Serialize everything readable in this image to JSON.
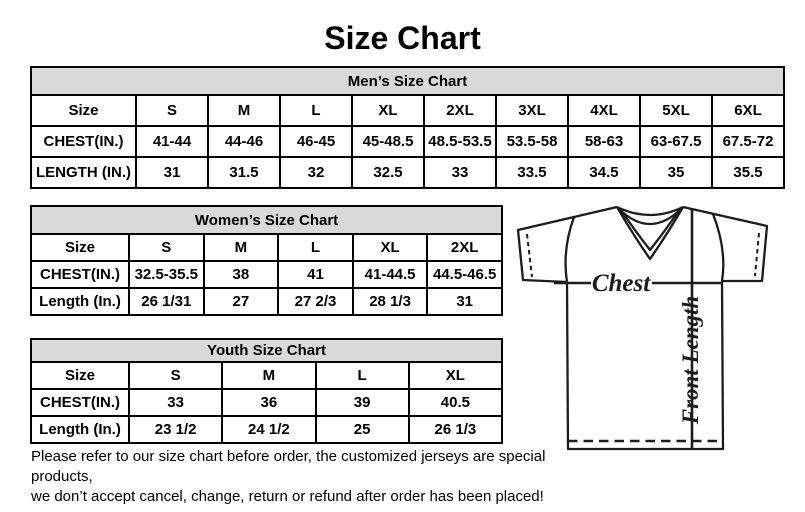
{
  "title": "Size Chart",
  "mens": {
    "header": "Men’s Size Chart",
    "rows": [
      {
        "label": "Size",
        "values": [
          "S",
          "M",
          "L",
          "XL",
          "2XL",
          "3XL",
          "4XL",
          "5XL",
          "6XL"
        ]
      },
      {
        "label": "CHEST(IN.)",
        "values": [
          "41-44",
          "44-46",
          "46-45",
          "45-48.5",
          "48.5-53.5",
          "53.5-58",
          "58-63",
          "63-67.5",
          "67.5-72"
        ]
      },
      {
        "label": "LENGTH (IN.)",
        "values": [
          "31",
          "31.5",
          "32",
          "32.5",
          "33",
          "33.5",
          "34.5",
          "35",
          "35.5"
        ]
      }
    ]
  },
  "womens": {
    "header": "Women’s Size Chart",
    "rows": [
      {
        "label": "Size",
        "values": [
          "S",
          "M",
          "L",
          "XL",
          "2XL"
        ]
      },
      {
        "label": "CHEST(IN.)",
        "values": [
          "32.5-35.5",
          "38",
          "41",
          "41-44.5",
          "44.5-46.5"
        ]
      },
      {
        "label": "Length (In.)",
        "values": [
          "26 1/31",
          "27",
          "27 2/3",
          "28 1/3",
          "31"
        ]
      }
    ]
  },
  "youth": {
    "header": "Youth Size Chart",
    "rows": [
      {
        "label": "Size",
        "values": [
          "S",
          "M",
          "L",
          "XL"
        ]
      },
      {
        "label": "CHEST(IN.)",
        "values": [
          "33",
          "36",
          "39",
          "40.5"
        ]
      },
      {
        "label": "Length (In.)",
        "values": [
          "23 1/2",
          "24 1/2",
          "25",
          "26 1/3"
        ]
      }
    ]
  },
  "diagram": {
    "chest_label": "Chest",
    "front_length_label": "Front Length"
  },
  "disclaimer": {
    "line1": "Please refer to our size chart before order, the customized jerseys are special products,",
    "line2": "we don’t accept cancel, change, return or refund after order has been placed!"
  },
  "colors": {
    "background": "#ffffff",
    "table_header_bg": "#d9d9d9",
    "border": "#000000",
    "text": "#000000",
    "diagram_line": "#1c1c1c"
  }
}
